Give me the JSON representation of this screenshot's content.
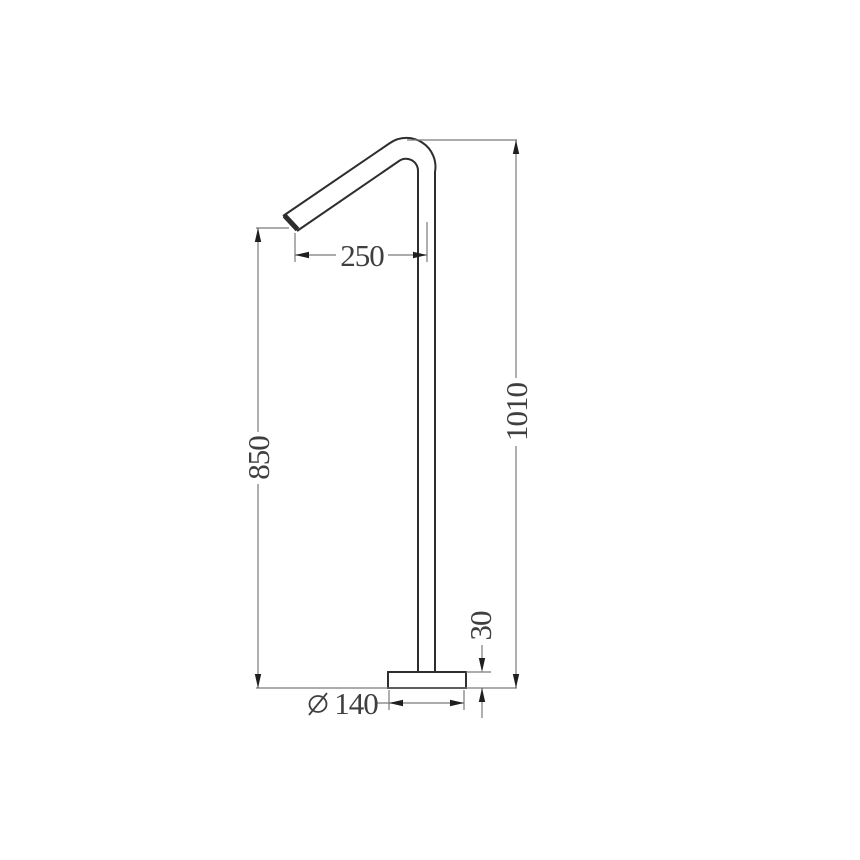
{
  "drawing": {
    "kind": "technical-dimension-drawing",
    "subject": "freestanding-spout-side-elevation",
    "background": "#ffffff",
    "colors": {
      "outline": "#2e2e2e",
      "dimension": "#7a7a7a",
      "arrow": "#1f1f1f",
      "text": "#3f3f3f"
    },
    "dimensions": {
      "reach": "250",
      "outlet_height": "850",
      "overall_height": "1010",
      "base_thickness": "30",
      "base_diameter": "140",
      "diameter_symbol": "∅"
    }
  }
}
